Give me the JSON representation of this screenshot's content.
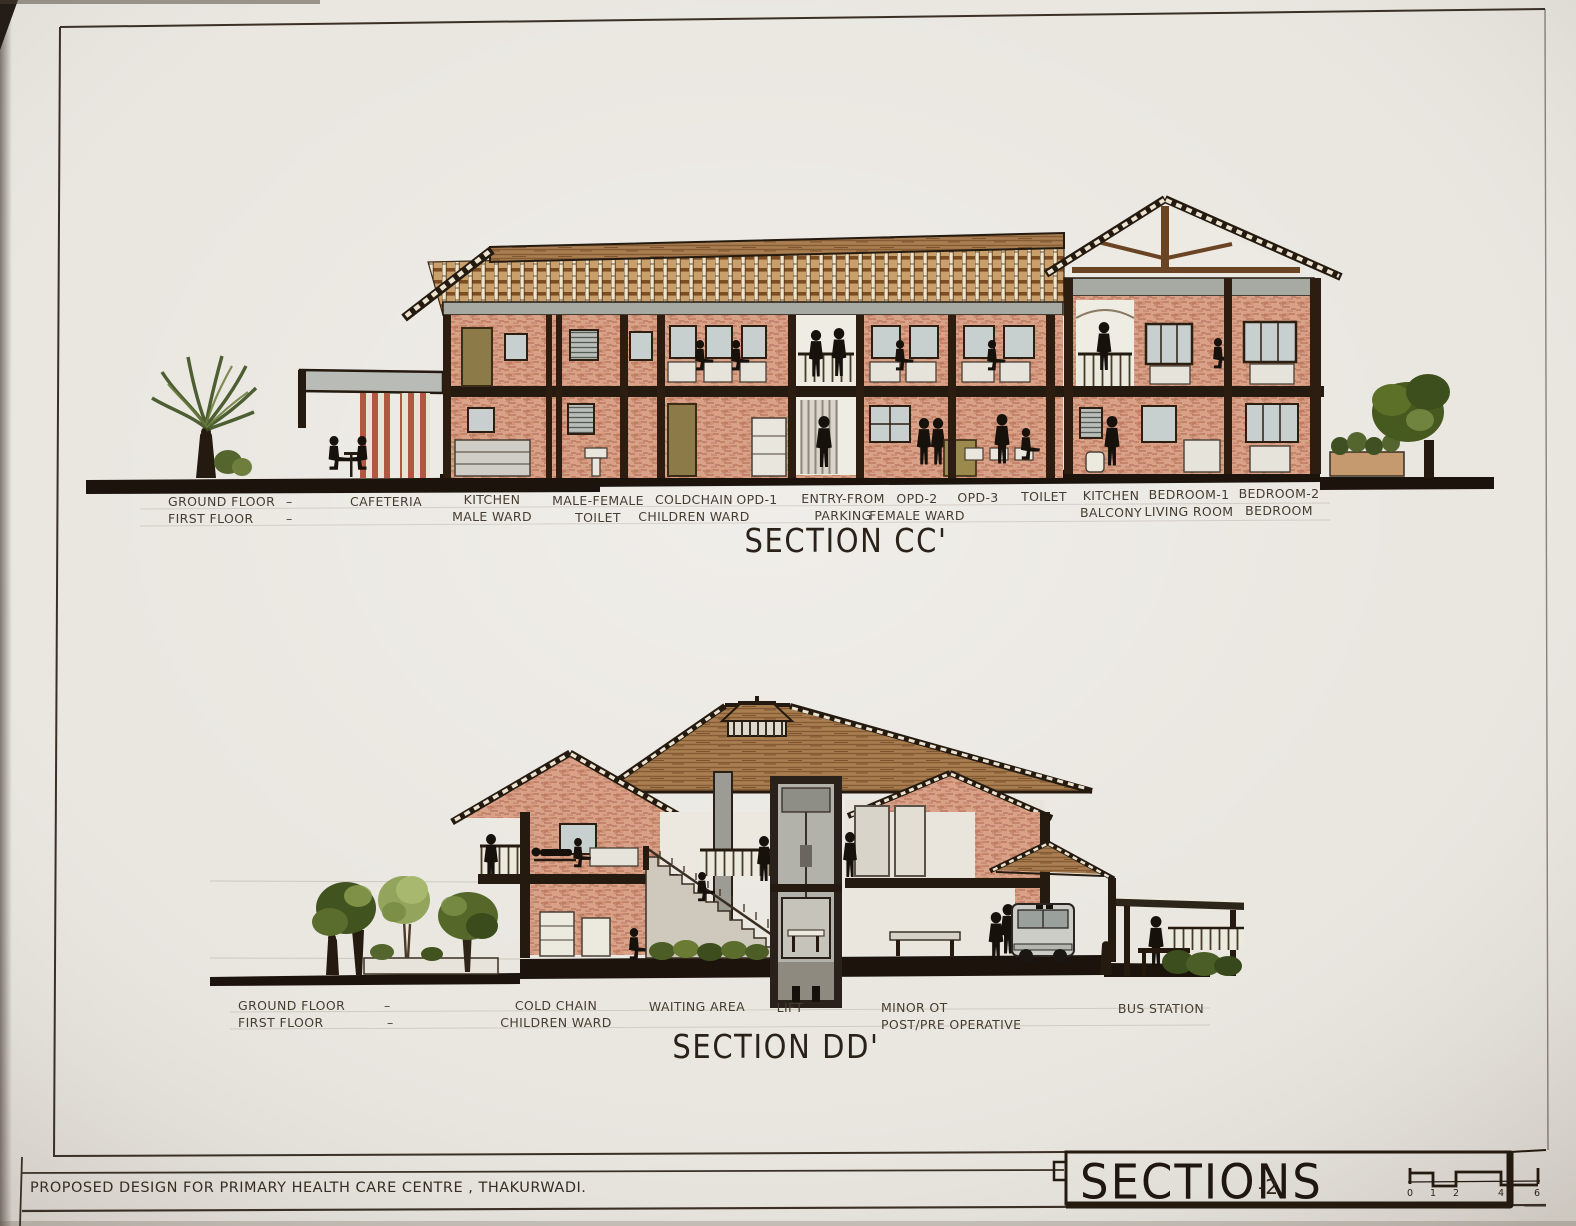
{
  "sheet": {
    "paper_color": "#eae7e1",
    "ink_color": "#2b2119",
    "project_caption": "PROPOSED DESIGN FOR PRIMARY HEALTH CARE CENTRE , THAKURWADI.",
    "title_block": {
      "title": "SECTIONS",
      "sheet_number": "-2"
    },
    "scale_bar": {
      "tick_labels": [
        "0",
        "1",
        "2",
        "4",
        "6"
      ]
    }
  },
  "palette": {
    "brick_wash": "#d8a188",
    "brick_hatch": "#a85a40",
    "roof_wood": "#a97f52",
    "roof_dark_edge": "#241a10",
    "rafter_grid_cream": "#efe5cc",
    "structure_dark": "#241a10",
    "window_glass": "#c7cfcf",
    "door_olive": "#8c7a48",
    "slab_grey": "#a7aaa2",
    "lift_grey": "#b3b2aa",
    "tree_dark_green": "#41541f",
    "tree_light_green": "#93a45c",
    "column_stripe_red": "#b15742",
    "figure_black": "#17110c"
  },
  "section_cc": {
    "title": "SECTION CC'",
    "floor_legend": {
      "row1_label": "GROUND FLOOR",
      "row1_dash": "–",
      "row2_label": "FIRST FLOOR",
      "row2_dash": "–"
    },
    "room_labels": [
      {
        "line1": "CAFETERIA",
        "line2": ""
      },
      {
        "line1": "KITCHEN",
        "line2": "MALE WARD"
      },
      {
        "line1": "MALE-FEMALE",
        "line2": "TOILET"
      },
      {
        "line1": "COLDCHAIN",
        "line2": "CHILDREN WARD"
      },
      {
        "line1": "OPD-1",
        "line2": ""
      },
      {
        "line1": "ENTRY-FROM",
        "line2": "PARKING"
      },
      {
        "line1": "OPD-2",
        "line2": "FEMALE WARD"
      },
      {
        "line1": "OPD-3",
        "line2": ""
      },
      {
        "line1": "TOILET",
        "line2": ""
      },
      {
        "line1": "KITCHEN",
        "line2": "BALCONY"
      },
      {
        "line1": "BEDROOM-1",
        "line2": "LIVING ROOM"
      },
      {
        "line1": "BEDROOM-2",
        "line2": "BEDROOM"
      }
    ]
  },
  "section_dd": {
    "title": "SECTION DD'",
    "floor_legend": {
      "row1_label": "GROUND FLOOR",
      "row1_dash": "–",
      "row2_label": "FIRST FLOOR",
      "row2_dash": "–"
    },
    "room_labels": [
      {
        "line1": "COLD CHAIN",
        "line2": "CHILDREN WARD"
      },
      {
        "line1": "WAITING AREA",
        "line2": ""
      },
      {
        "line1": "LIFT",
        "line2": ""
      },
      {
        "line1": "MINOR OT",
        "line2": "POST/PRE OPERATIVE"
      },
      {
        "line1": "BUS STATION",
        "line2": ""
      }
    ]
  }
}
